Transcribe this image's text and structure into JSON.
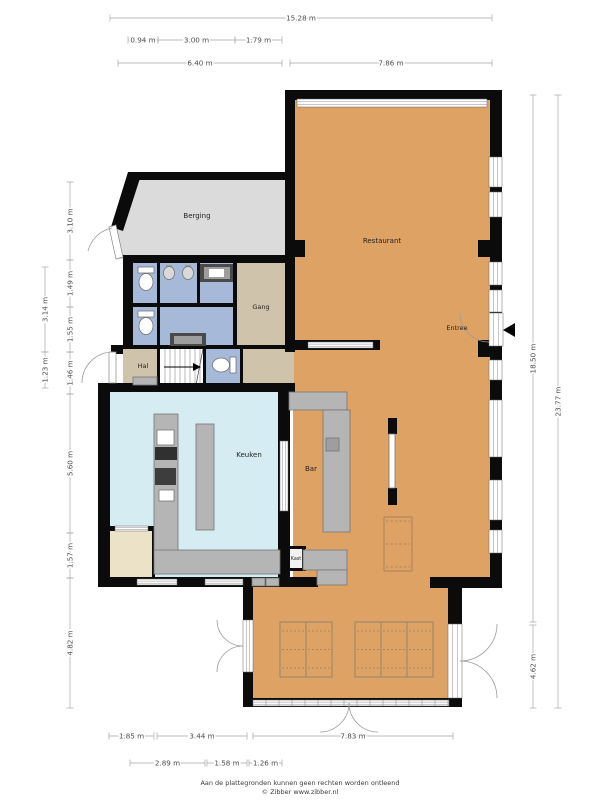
{
  "title": "Floor plan",
  "footer": {
    "line1": "Aan de plattegronden kunnen geen rechten worden ontleend",
    "line2": "© Zibber www.zibber.nl"
  },
  "colors": {
    "wall": "#0b0b0b",
    "restaurant": "#dfa265",
    "keuken": "#d4ecf2",
    "toilet": "#a6b9d8",
    "tan": "#cfc3ab",
    "berging": "#dbdbdb",
    "cream": "#ebe2c7",
    "counter": "#b5b5b5",
    "counterEdge": "#757575",
    "darkFix": "#4a4a4a",
    "midFix": "#9e9e9e",
    "dimLine": "#a5a5a5",
    "dimText": "#4d4d4d",
    "roomText": "#1f1f1f",
    "arc": "#9b9b9b",
    "winFrame": "#8f8f8f",
    "tableLine": "#8b8270",
    "dashBrown": "#9b7c58",
    "stairLine": "#9a9a9a"
  },
  "rooms": [
    {
      "name": "berging",
      "label": "Berging",
      "x": 197,
      "y": 218,
      "fs": 7
    },
    {
      "name": "restaurant",
      "label": "Restaurant",
      "x": 382,
      "y": 243,
      "fs": 7
    },
    {
      "name": "gang",
      "label": "Gang",
      "x": 261,
      "y": 309,
      "fs": 6.5
    },
    {
      "name": "hal",
      "label": "Hal",
      "x": 143,
      "y": 368,
      "fs": 6.5
    },
    {
      "name": "keuken",
      "label": "Keuken",
      "x": 249,
      "y": 457,
      "fs": 7
    },
    {
      "name": "bar",
      "label": "Bar",
      "x": 311,
      "y": 471,
      "fs": 7
    },
    {
      "name": "entree",
      "label": "Entree",
      "x": 457,
      "y": 330,
      "fs": 6.5
    },
    {
      "name": "kast",
      "label": "Kast",
      "x": 296,
      "y": 560,
      "fs": 4.8
    }
  ],
  "dimensions": {
    "top": [
      {
        "label": "15.28 m",
        "x1": 110,
        "x2": 492,
        "y": 18
      },
      {
        "label": "0.94 m",
        "x1": 128,
        "x2": 158,
        "y": 40
      },
      {
        "label": "3.00 m",
        "x1": 158,
        "x2": 235,
        "y": 40
      },
      {
        "label": "1.79 m",
        "x1": 235,
        "x2": 282,
        "y": 40
      },
      {
        "label": "6.40 m",
        "x1": 118,
        "x2": 282,
        "y": 63
      },
      {
        "label": "7.86 m",
        "x1": 290,
        "x2": 492,
        "y": 63
      }
    ],
    "bottom": [
      {
        "label": "1.85 m",
        "x1": 109,
        "x2": 154,
        "y": 736
      },
      {
        "label": "3.44 m",
        "x1": 157,
        "x2": 247,
        "y": 736
      },
      {
        "label": "7.83 m",
        "x1": 253,
        "x2": 453,
        "y": 736
      },
      {
        "label": "2.89 m",
        "x1": 130,
        "x2": 205,
        "y": 763
      },
      {
        "label": "1.58 m",
        "x1": 207,
        "x2": 247,
        "y": 763
      },
      {
        "label": "1.26 m",
        "x1": 249,
        "x2": 282,
        "y": 763
      }
    ],
    "left": [
      {
        "label": "3.10 m",
        "x": 70,
        "y1": 182,
        "y2": 260
      },
      {
        "label": "1.49 m",
        "x": 70,
        "y1": 260,
        "y2": 307
      },
      {
        "label": "1.55 m",
        "x": 70,
        "y1": 307,
        "y2": 352
      },
      {
        "label": "1.46 m",
        "x": 70,
        "y1": 352,
        "y2": 394
      },
      {
        "label": "5.60 m",
        "x": 70,
        "y1": 394,
        "y2": 533
      },
      {
        "label": "1.57 m",
        "x": 70,
        "y1": 533,
        "y2": 578
      },
      {
        "label": "4.82 m",
        "x": 70,
        "y1": 578,
        "y2": 708
      },
      {
        "label": "3.14 m",
        "x": 45,
        "y1": 267,
        "y2": 352
      },
      {
        "label": "1.23 m",
        "x": 45,
        "y1": 352,
        "y2": 388
      }
    ],
    "right": [
      {
        "label": "18.50 m",
        "x": 533,
        "y1": 95,
        "y2": 622
      },
      {
        "label": "4.62 m",
        "x": 533,
        "y1": 625,
        "y2": 708
      },
      {
        "label": "23.77 m",
        "x": 558,
        "y1": 95,
        "y2": 708
      }
    ]
  },
  "plan": {
    "floors": [
      {
        "n": "berging-floor",
        "f": "berging",
        "poly": [
          [
            132,
            176
          ],
          [
            286,
            176
          ],
          [
            286,
            259
          ],
          [
            118,
            259
          ],
          [
            116,
            228
          ]
        ]
      },
      {
        "n": "restaurant-floor",
        "f": "restaurant",
        "r": [
          293,
          98,
          199,
          482
        ]
      },
      {
        "n": "terrace-floor",
        "f": "restaurant",
        "r": [
          251,
          580,
          203,
          122
        ]
      },
      {
        "n": "gang-floor",
        "f": "tan",
        "r": [
          128,
          260,
          160,
          90
        ]
      },
      {
        "n": "corridor-floor",
        "f": "tan",
        "r": [
          123,
          348,
          171,
          37
        ]
      },
      {
        "n": "toilet1-floor",
        "f": "toilet",
        "r": [
          133,
          263,
          24,
          41
        ]
      },
      {
        "n": "toilet2-floor",
        "f": "toilet",
        "r": [
          160,
          263,
          37,
          41
        ]
      },
      {
        "n": "toilet3-floor",
        "f": "toilet",
        "r": [
          200,
          263,
          33,
          41
        ]
      },
      {
        "n": "toilet4-floor",
        "f": "toilet",
        "r": [
          133,
          307,
          24,
          38
        ]
      },
      {
        "n": "toilet5-floor",
        "f": "toilet",
        "r": [
          160,
          307,
          73,
          38
        ]
      },
      {
        "n": "toilet6-floor",
        "f": "toilet",
        "r": [
          206,
          349,
          34,
          35
        ]
      },
      {
        "n": "keuken-floor",
        "f": "keuken",
        "r": [
          108,
          390,
          172,
          187
        ]
      },
      {
        "n": "cream-room-floor",
        "f": "cream",
        "r": [
          108,
          530,
          47,
          47
        ]
      },
      {
        "n": "kast-floor",
        "f": "#f2f2f2",
        "r": [
          288,
          548,
          16,
          20
        ]
      }
    ],
    "walls": [
      [
        285,
        90,
        217,
        10
      ],
      [
        490,
        100,
        12,
        488
      ],
      [
        285,
        100,
        10,
        252
      ],
      [
        128,
        172,
        162,
        8
      ],
      [
        123,
        255,
        167,
        8
      ],
      [
        123,
        263,
        10,
        84
      ],
      [
        111,
        345,
        12,
        9
      ],
      [
        98,
        383,
        197,
        9
      ],
      [
        98,
        392,
        12,
        187
      ],
      [
        278,
        383,
        12,
        194
      ],
      [
        98,
        577,
        148,
        10
      ],
      [
        243,
        577,
        75,
        10
      ],
      [
        430,
        577,
        72,
        11
      ],
      [
        243,
        587,
        10,
        120
      ],
      [
        243,
        698,
        219,
        9
      ],
      [
        448,
        587,
        14,
        120
      ],
      [
        295,
        340,
        85,
        10
      ],
      [
        478,
        240,
        12,
        17
      ],
      [
        295,
        240,
        10,
        17
      ],
      [
        478,
        340,
        12,
        17
      ],
      [
        388,
        418,
        9,
        16
      ],
      [
        388,
        488,
        9,
        17
      ],
      [
        108,
        526,
        47,
        5
      ],
      [
        157,
        263,
        3,
        41
      ],
      [
        197,
        263,
        3,
        41
      ],
      [
        233,
        263,
        4,
        86
      ],
      [
        133,
        303,
        104,
        4
      ],
      [
        157,
        307,
        3,
        38
      ],
      [
        123,
        345,
        167,
        4
      ],
      [
        157,
        349,
        3,
        36
      ],
      [
        203,
        349,
        3,
        36
      ],
      [
        240,
        349,
        3,
        36
      ],
      [
        152,
        530,
        3,
        47
      ],
      [
        286,
        546,
        20,
        3
      ],
      [
        286,
        548,
        3,
        22
      ],
      [
        302,
        548,
        3,
        22
      ],
      [
        286,
        568,
        20,
        3
      ]
    ],
    "wallPolys": [
      [
        [
          128,
          172
        ],
        [
          142,
          172
        ],
        [
          123,
          231
        ],
        [
          111,
          227
        ]
      ]
    ],
    "windows": [
      {
        "r": [
          297,
          99,
          190,
          8
        ],
        "o": "h"
      },
      {
        "r": [
          489,
          157,
          13,
          30
        ],
        "o": "v"
      },
      {
        "r": [
          489,
          192,
          13,
          25
        ],
        "o": "v"
      },
      {
        "r": [
          489,
          262,
          13,
          23
        ],
        "o": "v"
      },
      {
        "r": [
          489,
          290,
          13,
          22
        ],
        "o": "v"
      },
      {
        "r": [
          489,
          360,
          13,
          20
        ],
        "o": "v"
      },
      {
        "r": [
          489,
          400,
          13,
          57
        ],
        "o": "v"
      },
      {
        "r": [
          489,
          480,
          13,
          40
        ],
        "o": "v"
      },
      {
        "r": [
          489,
          530,
          13,
          23
        ],
        "o": "v"
      },
      {
        "r": [
          308,
          342,
          65,
          6
        ],
        "o": "h"
      },
      {
        "r": [
          280,
          441,
          8,
          70
        ],
        "o": "v"
      },
      {
        "r": [
          115,
          526,
          33,
          5
        ],
        "o": "h"
      },
      {
        "r": [
          137,
          579,
          40,
          6
        ],
        "o": "h"
      },
      {
        "r": [
          205,
          579,
          38,
          6
        ],
        "o": "h"
      },
      {
        "r": [
          253,
          700,
          196,
          6
        ],
        "o": "h",
        "m": true
      },
      {
        "r": [
          489,
          313,
          14,
          33
        ],
        "o": "v"
      },
      {
        "r": [
          243,
          620,
          10,
          52
        ],
        "o": "v"
      },
      {
        "r": [
          448,
          624,
          14,
          74
        ],
        "o": "v"
      }
    ],
    "fixtures": [
      {
        "r": [
          200,
          264,
          33,
          18
        ],
        "f": "darkFix"
      },
      {
        "r": [
          204,
          267,
          26,
          12
        ],
        "f": "midFix"
      },
      {
        "r": [
          209,
          269,
          15,
          8
        ],
        "f": "#ffffff"
      },
      {
        "r": [
          170,
          333,
          36,
          13
        ],
        "f": "darkFix"
      },
      {
        "r": [
          174,
          336,
          28,
          8
        ],
        "f": "midFix"
      },
      {
        "r": [
          166,
          265,
          6,
          4
        ],
        "f": "midFix"
      },
      {
        "r": [
          185,
          265,
          6,
          4
        ],
        "f": "midFix"
      },
      {
        "r": [
          133,
          377,
          24,
          8
        ],
        "f": "counter",
        "s": "counterEdge"
      },
      {
        "r": [
          196,
          424,
          18,
          106
        ],
        "f": "counter",
        "s": "counterEdge"
      },
      {
        "r": [
          154,
          414,
          24,
          142
        ],
        "f": "counter",
        "s": "counterEdge"
      },
      {
        "r": [
          154,
          550,
          126,
          24
        ],
        "f": "counter",
        "s": "counterEdge"
      },
      {
        "r": [
          157,
          430,
          17,
          15
        ],
        "f": "#ffffff",
        "s": "counterEdge"
      },
      {
        "r": [
          155,
          447,
          22,
          13
        ],
        "f": "#303030"
      },
      {
        "r": [
          155,
          468,
          21,
          17
        ],
        "f": "#3d3d3d"
      },
      {
        "r": [
          159,
          490,
          15,
          11
        ],
        "f": "#ffffff",
        "s": "counterEdge"
      },
      {
        "r": [
          289,
          392,
          58,
          18
        ],
        "f": "counter",
        "s": "counterEdge"
      },
      {
        "r": [
          323,
          410,
          27,
          122
        ],
        "f": "counter",
        "s": "counterEdge"
      },
      {
        "r": [
          326,
          438,
          13,
          13
        ],
        "f": "midFix",
        "s": "counterEdge"
      },
      {
        "r": [
          303,
          550,
          44,
          20
        ],
        "f": "counter",
        "s": "counterEdge"
      },
      {
        "r": [
          317,
          570,
          30,
          15
        ],
        "f": "counter",
        "s": "counterEdge"
      },
      {
        "r": [
          252,
          578,
          13,
          8
        ],
        "f": "counter",
        "s": "counterEdge"
      },
      {
        "r": [
          266,
          578,
          13,
          8
        ],
        "f": "counter",
        "s": "counterEdge"
      },
      {
        "r": [
          138,
          267,
          16,
          6
        ],
        "f": "#ffffff",
        "s": "counterEdge"
      },
      {
        "r": [
          138,
          311,
          16,
          6
        ],
        "f": "#ffffff",
        "s": "counterEdge"
      },
      {
        "r": [
          230,
          357,
          6,
          16
        ],
        "f": "#ffffff",
        "s": "counterEdge"
      },
      {
        "r": [
          389,
          434,
          6,
          54
        ],
        "f": "#ffffff",
        "s": "counterEdge"
      }
    ],
    "ellipses": [
      {
        "c": [
          146,
          282
        ],
        "rx": 7,
        "ry": 8.5,
        "f": "#ffffff",
        "s": "#6e6e6e"
      },
      {
        "c": [
          146,
          326
        ],
        "rx": 7,
        "ry": 8.5,
        "f": "#ffffff",
        "s": "#6e6e6e"
      },
      {
        "c": [
          221,
          365
        ],
        "rx": 8.5,
        "ry": 7,
        "f": "#ffffff",
        "s": "#6e6e6e"
      },
      {
        "c": [
          169,
          273
        ],
        "rx": 5.5,
        "ry": 6.5,
        "f": "#d9d9d9",
        "s": "#6e6e6e"
      },
      {
        "c": [
          188,
          273
        ],
        "rx": 5.5,
        "ry": 6.5,
        "f": "#d9d9d9",
        "s": "#6e6e6e"
      }
    ],
    "stairs": {
      "r": [
        160,
        349,
        43,
        36
      ],
      "treadsX": [
        165,
        170,
        175,
        180,
        185,
        190,
        195,
        200
      ],
      "diag": [
        196,
        385,
        203,
        349
      ],
      "arrow": [
        164,
        367,
        193,
        367
      ]
    },
    "dashedRect": {
      "r": [
        384,
        517,
        28,
        54
      ]
    },
    "tables": [
      {
        "x": 280,
        "y": 622,
        "w": 52,
        "h": 55,
        "cols": 2
      },
      {
        "x": 355,
        "y": 622,
        "w": 78,
        "h": 55,
        "cols": 3
      }
    ],
    "doorLeaves": [
      {
        "poly": [
          [
            109,
            227
          ],
          [
            116,
            225
          ],
          [
            123,
            257
          ],
          [
            116,
            259
          ]
        ]
      },
      {
        "r": [
          109,
          352,
          7,
          31
        ]
      }
    ],
    "doorArcs": [
      "M 112,228 A 31,31 0 0 0 88,251",
      "M 113,352 A 31,31 0 0 0 82,383",
      "M 489,342 A 29,29 0 0 1 460,313",
      "M 243,646 A 26,26 0 0 1 217,620",
      "M 243,646 A 26,26 0 0 0 217,672",
      "M 460,661 A 37,37 0 0 0 497,624",
      "M 460,661 A 37,37 0 0 1 497,698",
      "M 349,703 A 29,29 0 0 1 320,732",
      "M 349,703 A 29,29 0 0 0 378,732"
    ],
    "entreeArrow": [
      [
        503,
        330
      ],
      [
        515,
        323
      ],
      [
        515,
        337
      ]
    ]
  }
}
